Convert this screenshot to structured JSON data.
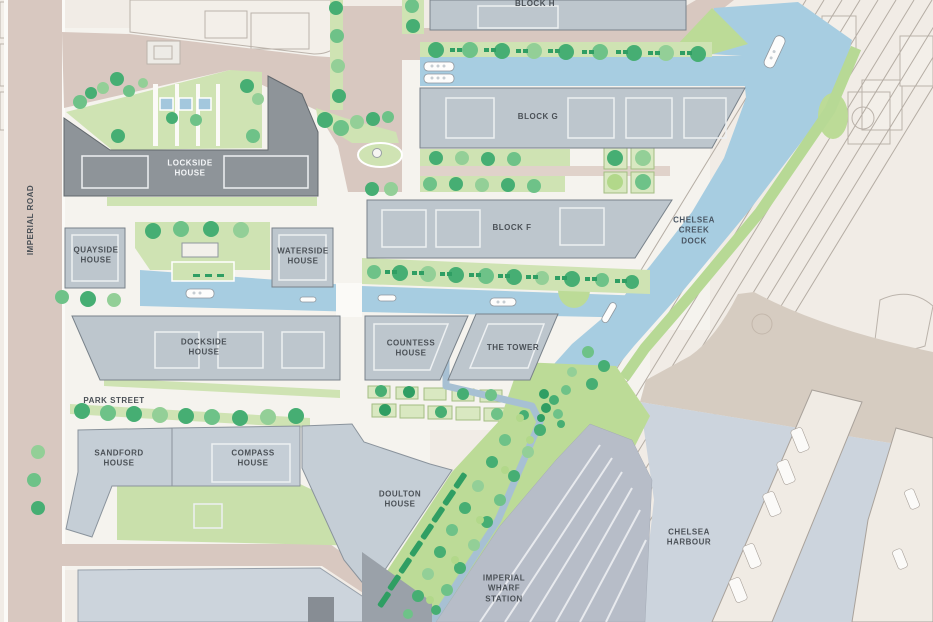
{
  "title": "Chelsea Creek development masterplan site map",
  "colors": {
    "background": "#f1ece6",
    "road": "#d8c8c0",
    "water": "#a7cde1",
    "harbour_water": "#ccd4dd",
    "green_space": "#cfe3b3",
    "building": "#bdc6cd",
    "building_dark": "#8e9499",
    "label_text": "#4b5157"
  },
  "labels": {
    "imperial_road": "IMPERIAL ROAD",
    "park_street": "PARK STREET",
    "block_h": "BLOCK H",
    "block_g": "BLOCK G",
    "block_f": "BLOCK F",
    "chelsea_creek_dock": [
      "CHELSEA",
      "CREEK",
      "DOCK"
    ],
    "lockside_house": [
      "LOCKSIDE",
      "HOUSE"
    ],
    "quayside_house": [
      "QUAYSIDE",
      "HOUSE"
    ],
    "waterside_house": [
      "WATERSIDE",
      "HOUSE"
    ],
    "dockside_house": [
      "DOCKSIDE",
      "HOUSE"
    ],
    "countess_house": [
      "COUNTESS",
      "HOUSE"
    ],
    "the_tower": "THE TOWER",
    "sandford_house": [
      "SANDFORD",
      "HOUSE"
    ],
    "compass_house": [
      "COMPASS",
      "HOUSE"
    ],
    "doulton_house": [
      "DOULTON",
      "HOUSE"
    ],
    "imperial_wharf_station": [
      "IMPERIAL",
      "WHARF",
      "STATION"
    ],
    "chelsea_harbour": [
      "CHELSEA",
      "HARBOUR"
    ]
  }
}
